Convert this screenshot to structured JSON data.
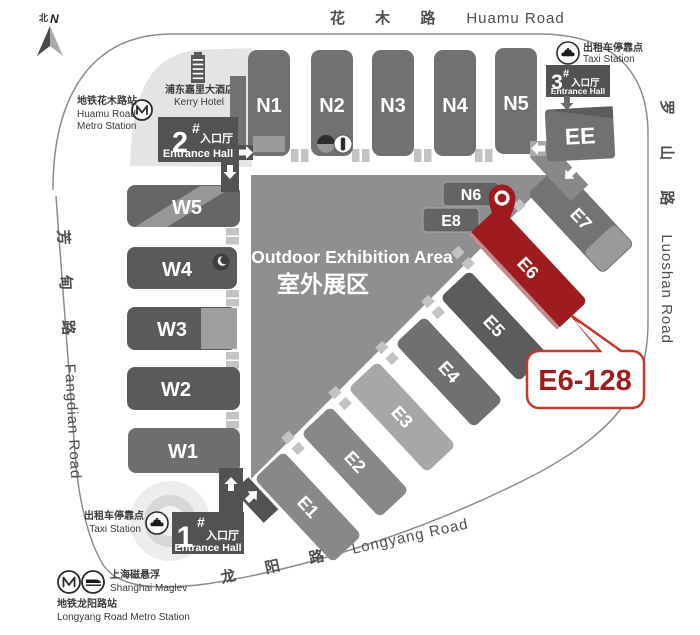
{
  "roads": {
    "huamu_zh": "花 木 路",
    "huamu_en": "Huamu Road",
    "luoshan_zh": "罗 山 路",
    "luoshan_en": "Luoshan Road",
    "fangdian_zh": "芳 甸 路",
    "fangdian_en": "Fangdian Road",
    "longyang_zh": "龙 阳 路",
    "longyang_en": "Longyang Road"
  },
  "compass": {
    "label_zh": "北",
    "label_en": "N"
  },
  "halls": {
    "north": [
      "N1",
      "N2",
      "N3",
      "N4",
      "N5"
    ],
    "west": [
      "W5",
      "W4",
      "W3",
      "W2",
      "W1"
    ],
    "east": [
      "E1",
      "E2",
      "E3",
      "E4",
      "E5",
      "E6",
      "E7"
    ],
    "north_small": "N6",
    "east_small": "E8",
    "ee": "EE"
  },
  "outdoor": {
    "en": "Outdoor Exhibition Area",
    "zh": "室外展区"
  },
  "entrance1": {
    "num": "1",
    "hash": "#",
    "zh": "入口厅",
    "en": "Entrance Hall"
  },
  "entrance2": {
    "num": "2",
    "hash": "#",
    "zh": "入口厅",
    "en": "Entrance Hall"
  },
  "entrance3": {
    "num": "3",
    "hash": "#",
    "zh": "入口厅",
    "en": "Entrance Hall"
  },
  "landmarks": {
    "kerry_zh": "浦东嘉里大酒店",
    "kerry_en": "Kerry Hotel",
    "huamu_metro_zh": "地铁花木路站",
    "huamu_metro_en1": "Huamu Road",
    "huamu_metro_en2": "Metro Station",
    "taxi_zh": "出租车停靠点",
    "taxi_en": "Taxi Station",
    "maglev_zh": "上海磁悬浮",
    "maglev_en": "Shanghai Maglev",
    "longyang_metro_zh": "地铁龙阳路站",
    "longyang_metro_en": "Longyang Road Metro Station"
  },
  "highlight": {
    "booth": "E6-128",
    "hall": "E6",
    "hall_color": "#9e1b1f",
    "callout_border": "#c5372f",
    "text_color": "#9e1b1f"
  }
}
